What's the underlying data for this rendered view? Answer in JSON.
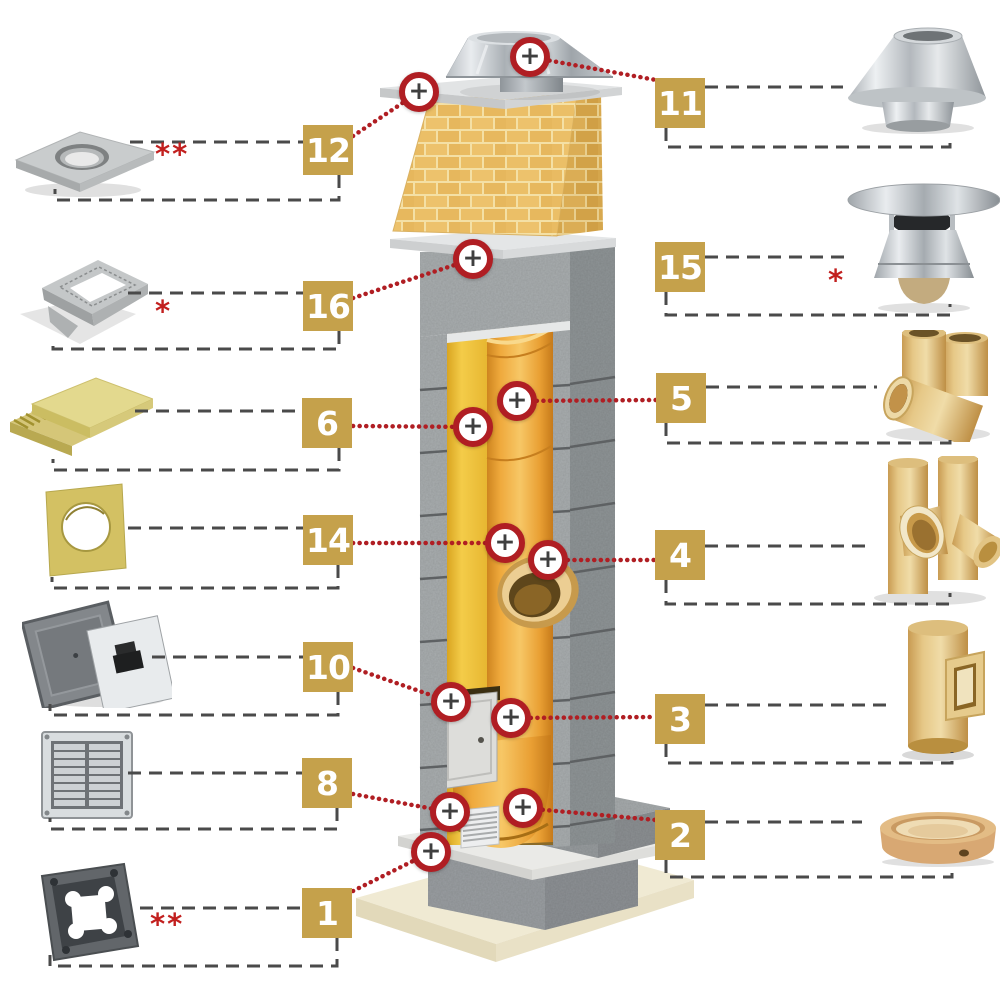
{
  "canvas": {
    "width": 1000,
    "height": 1000,
    "background": "#ffffff"
  },
  "palette": {
    "label_bg": "#C5A14B",
    "label_text": "#ffffff",
    "marker_ring": "#B01E23",
    "marker_bg": "#ffffff",
    "marker_plus": "#3F3F3F",
    "dash_line": "#4A4A4A",
    "dotted_line": "#B01E23",
    "note_red": "#C2201F",
    "ceramic": "#E2C17E",
    "liner_orange": "#EFA93C",
    "insulation_yellow": "#F4CC49",
    "concrete_gray": "#A9ADAF",
    "brick_tan": "#EBBF67"
  },
  "icons": {
    "plus": "+"
  },
  "parts": {
    "p1": {
      "number": "1",
      "note": "**"
    },
    "p2": {
      "number": "2",
      "note": ""
    },
    "p3": {
      "number": "3",
      "note": ""
    },
    "p4": {
      "number": "4",
      "note": ""
    },
    "p5": {
      "number": "5",
      "note": ""
    },
    "p6": {
      "number": "6",
      "note": ""
    },
    "p8": {
      "number": "8",
      "note": ""
    },
    "p10": {
      "number": "10",
      "note": ""
    },
    "p11": {
      "number": "11",
      "note": ""
    },
    "p12": {
      "number": "12",
      "note": "**"
    },
    "p14": {
      "number": "14",
      "note": ""
    },
    "p15": {
      "number": "15",
      "note": "*"
    },
    "p16": {
      "number": "16",
      "note": "*"
    }
  }
}
